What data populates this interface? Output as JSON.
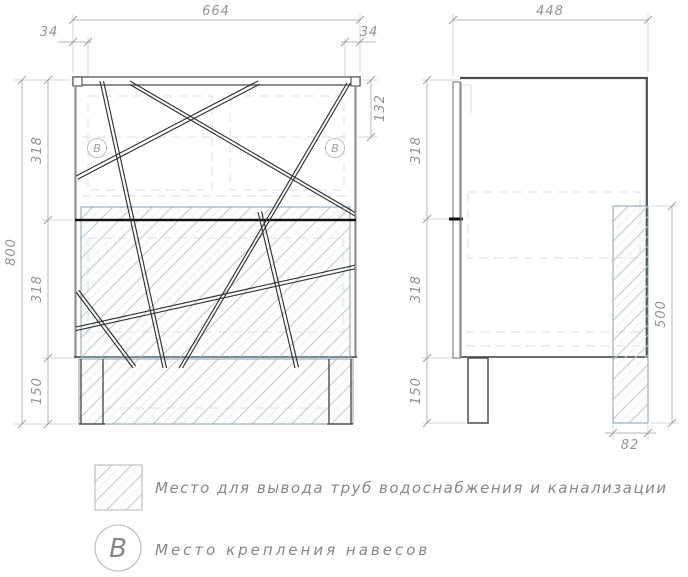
{
  "front_view": {
    "dim_width_total": "664",
    "dim_offset_left": "34",
    "dim_offset_right": "34",
    "dim_hanger_drop": "132",
    "dim_height_total": "800",
    "dim_section_top": "318",
    "dim_section_mid": "318",
    "dim_legs": "150",
    "marker_left": "B",
    "marker_right": "B"
  },
  "side_view": {
    "dim_depth_total": "448",
    "dim_section_top": "318",
    "dim_section_mid": "318",
    "dim_legs": "150",
    "dim_pipe_zone_height": "500",
    "dim_pipe_zone_depth": "82"
  },
  "legend": {
    "pipe_zone_label": "Место для вывода труб водоснабжения и канализации",
    "hanger_marker_letter": "B",
    "hanger_label": "Место крепления навесов"
  },
  "colors": {
    "outline_dark": "#4b4f52",
    "outline_gray": "#8d9194",
    "divider_black": "#131313",
    "hatch_line": "#c3c8cc",
    "hatch_border": "#7d97a8",
    "dimension_line": "#b3b7ba",
    "dimension_text": "#8f9497",
    "legend_text": "#84888b"
  }
}
